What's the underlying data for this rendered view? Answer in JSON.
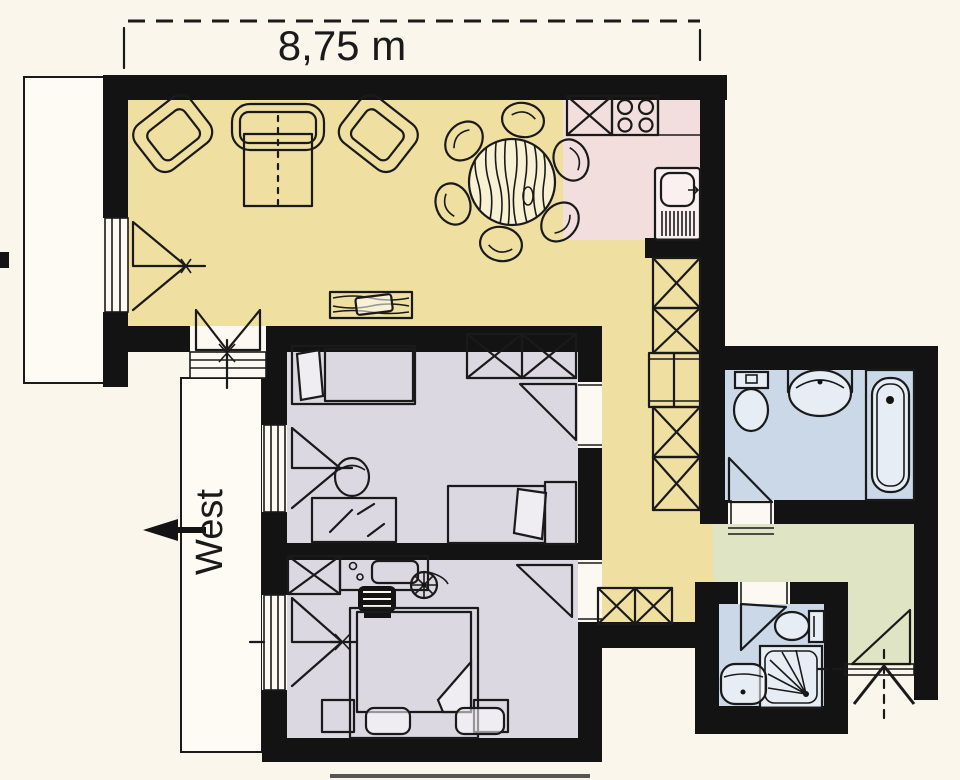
{
  "dimension": {
    "label": "8,75 m"
  },
  "compass": {
    "label": "West"
  },
  "colors": {
    "wall": "#131313",
    "line": "#1a1a1a",
    "paper": "#FAF6EC",
    "gap": "#FBF9F2",
    "living": "#EFDFA0",
    "kitchen": "#F2DEDC",
    "bedroom": "#DBD8E2",
    "bathroom": "#CAD8E8",
    "vestibule": "#DEE4C4",
    "balcony": "#FDFBF4"
  },
  "rooms": [
    {
      "id": "living-room",
      "color_key": "living",
      "fixtures": [
        "armchair-left",
        "sofa-foldout",
        "armchair-right",
        "dining-table-6-chairs",
        "sideboard",
        "balcony-door",
        "west-window"
      ]
    },
    {
      "id": "kitchen",
      "color_key": "kitchen",
      "fixtures": [
        "counter-sink-xbox",
        "stove-4-burners",
        "sink-with-drainer"
      ]
    },
    {
      "id": "hallway",
      "color_key": "living",
      "fixtures": [
        "closet-column-5",
        "double-wardrobe"
      ]
    },
    {
      "id": "bedroom-1",
      "color_key": "bedroom",
      "fixtures": [
        "single-bed-top",
        "double-wardrobe-x",
        "desk",
        "chair",
        "single-bed-bottom",
        "window",
        "door"
      ]
    },
    {
      "id": "bedroom-2",
      "color_key": "bedroom",
      "fixtures": [
        "wardrobe-x",
        "vanity-desk",
        "fan-stool",
        "dark-chair",
        "double-bed",
        "nightstand-left",
        "nightstand-right",
        "window",
        "door"
      ]
    },
    {
      "id": "bathroom",
      "color_key": "bathroom",
      "fixtures": [
        "toilet",
        "washbasin",
        "bathtub",
        "door"
      ]
    },
    {
      "id": "small-bathroom",
      "color_key": "bathroom",
      "fixtures": [
        "door",
        "toilet",
        "shower",
        "washbasin"
      ]
    },
    {
      "id": "vestibule",
      "color_key": "vestibule",
      "fixtures": [
        "french-window"
      ]
    },
    {
      "id": "balcony-west",
      "color_key": "balcony",
      "fixtures": []
    },
    {
      "id": "balcony-side",
      "color_key": "balcony",
      "fixtures": []
    }
  ]
}
